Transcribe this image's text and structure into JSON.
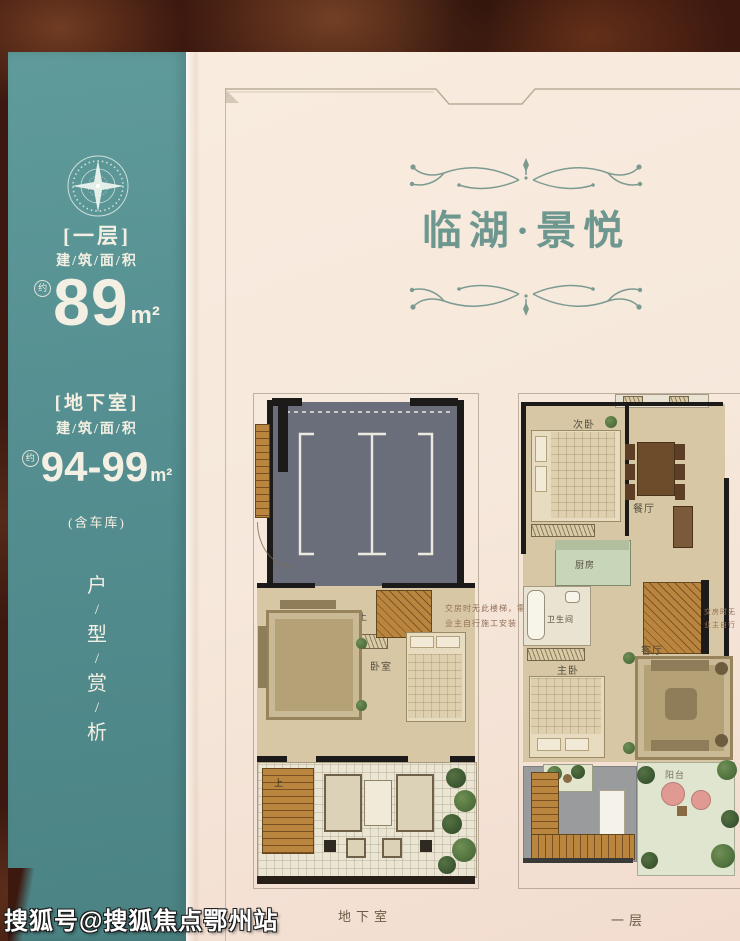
{
  "watermark": "搜狐号@搜狐焦点鄂州站",
  "header": {
    "title": "临湖·景悦"
  },
  "sidebar": {
    "floor1": {
      "tag": "[一层]",
      "area_words": "建/筑/面/积",
      "approx": "约",
      "value": "89",
      "unit": "m²"
    },
    "basement": {
      "tag": "[地下室]",
      "area_words": "建/筑/面/积",
      "approx": "约",
      "value": "94-99",
      "unit": "m²",
      "note": "(含车库)"
    },
    "vertical": {
      "c1": "户",
      "c2": "型",
      "c3": "赏",
      "c4": "析",
      "slash": "/"
    }
  },
  "plans": {
    "basement": {
      "caption": "地下室",
      "labels": {
        "bedroom": "卧室",
        "stair_up_mid": "上",
        "stair_up_patio": "上"
      },
      "annotation_line1": "交房时无此楼梯，需",
      "annotation_line2": "业主自行施工安装"
    },
    "first": {
      "caption": "一层",
      "labels": {
        "second_bedroom": "次卧",
        "dining": "餐厅",
        "kitchen": "厨房",
        "bathroom": "卫生间",
        "master_bedroom": "主卧",
        "living": "客厅",
        "balcony": "阳台",
        "stair_down": "下"
      },
      "annotation_line1": "交房时无",
      "annotation_line2": "业主自行"
    }
  },
  "colors": {
    "teal": "#548e90",
    "cream": "#f6e9dc",
    "title_green": "#6e978f",
    "slate": "#6a6e7b",
    "wood": "#b9853f",
    "beige": "#d7c7a5",
    "rug": "#b5a176",
    "kitchen": "#c7d6b8",
    "terrace": "#dfe5cf",
    "pink": "#e09a93",
    "plant": "#4e6e3c",
    "wall": "#1c1b19",
    "text_light": "#f4efe3",
    "label_brown": "#6b5c46",
    "annotation": "#946f55",
    "border_line": "#b9ac97"
  }
}
